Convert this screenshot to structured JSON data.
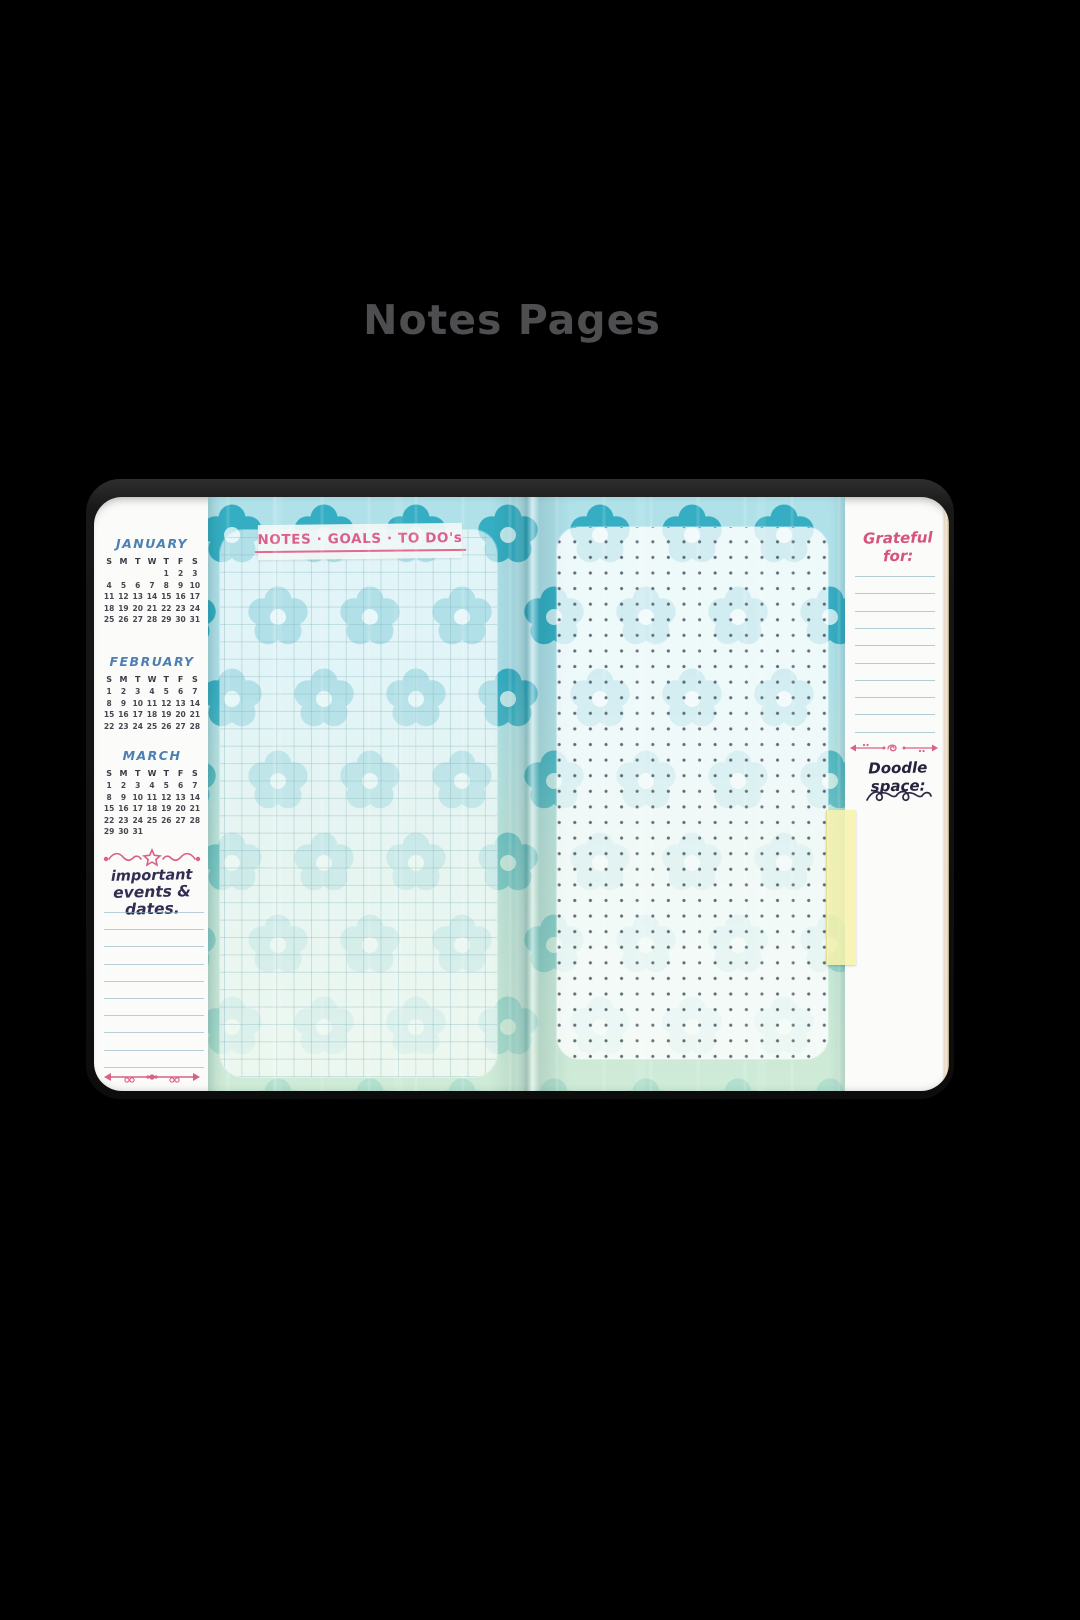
{
  "title": {
    "text": "Notes Pages",
    "color": "#4e4e50"
  },
  "notebook": {
    "left_sidebar": {
      "calendars": [
        {
          "month": "JANUARY",
          "day_headers": [
            "S",
            "M",
            "T",
            "W",
            "T",
            "F",
            "S"
          ],
          "weeks": [
            [
              "",
              "",
              "",
              "",
              "1",
              "2",
              "3"
            ],
            [
              "4",
              "5",
              "6",
              "7",
              "8",
              "9",
              "10"
            ],
            [
              "11",
              "12",
              "13",
              "14",
              "15",
              "16",
              "17"
            ],
            [
              "18",
              "19",
              "20",
              "21",
              "22",
              "23",
              "24"
            ],
            [
              "25",
              "26",
              "27",
              "28",
              "29",
              "30",
              "31"
            ]
          ]
        },
        {
          "month": "FEBRUARY",
          "day_headers": [
            "S",
            "M",
            "T",
            "W",
            "T",
            "F",
            "S"
          ],
          "weeks": [
            [
              "1",
              "2",
              "3",
              "4",
              "5",
              "6",
              "7"
            ],
            [
              "8",
              "9",
              "10",
              "11",
              "12",
              "13",
              "14"
            ],
            [
              "15",
              "16",
              "17",
              "18",
              "19",
              "20",
              "21"
            ],
            [
              "22",
              "23",
              "24",
              "25",
              "26",
              "27",
              "28"
            ]
          ]
        },
        {
          "month": "MARCH",
          "day_headers": [
            "S",
            "M",
            "T",
            "W",
            "T",
            "F",
            "S"
          ],
          "weeks": [
            [
              "1",
              "2",
              "3",
              "4",
              "5",
              "6",
              "7"
            ],
            [
              "8",
              "9",
              "10",
              "11",
              "12",
              "13",
              "14"
            ],
            [
              "15",
              "16",
              "17",
              "18",
              "19",
              "20",
              "21"
            ],
            [
              "22",
              "23",
              "24",
              "25",
              "26",
              "27",
              "28"
            ],
            [
              "29",
              "30",
              "31",
              "",
              "",
              "",
              ""
            ]
          ]
        }
      ],
      "events_heading_line1": "important",
      "events_heading_line2": "events & dates.",
      "ruled_lines": 10
    },
    "notes_page": {
      "label": "NOTES · GOALS · TO DO's"
    },
    "right_sidebar": {
      "grateful_label": "Grateful for:",
      "ruled_lines": 10,
      "doodle_label": "Doodle space:"
    },
    "colors": {
      "flower_teal_top": "#35aec3",
      "pattern_bg_top": "#b0e1e9",
      "flower_mint_bottom": "#8ecfbb",
      "pattern_bg_bottom": "#d6eee5",
      "accent_pink": "#db5f8a",
      "accent_blue": "#4c80b4",
      "ink_navy": "#322d53",
      "tab_yellow": "#f7f2ad"
    }
  }
}
